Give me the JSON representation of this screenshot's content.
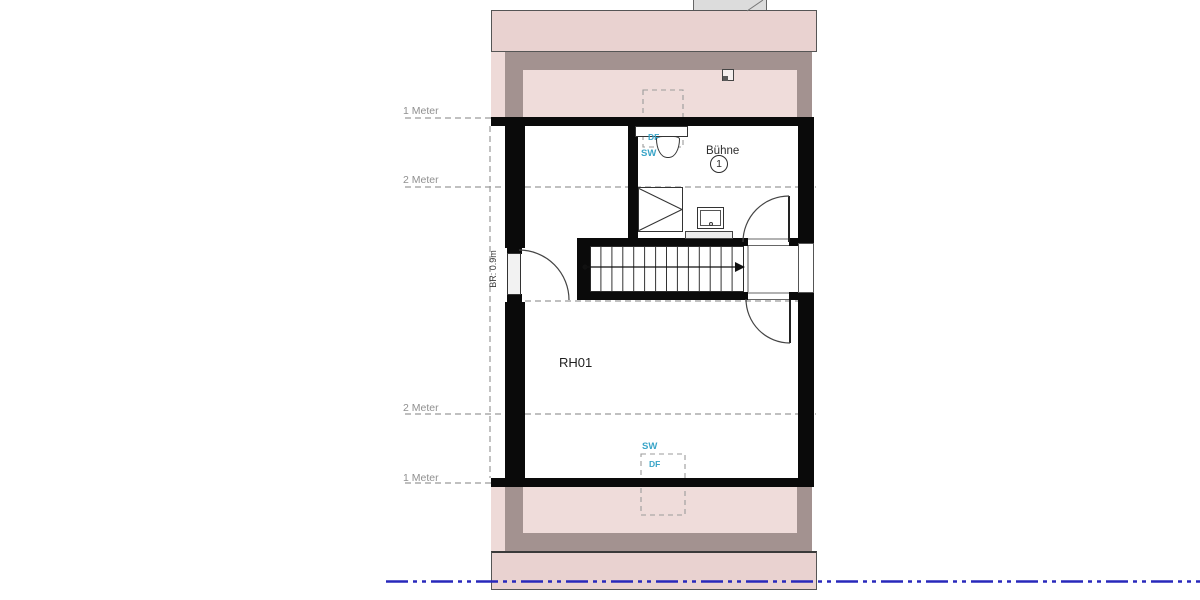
{
  "plan": {
    "room_main_label": "RH01",
    "room_upper_label": "Bühne",
    "room_upper_number": "1",
    "door_width_label": "BR: 0.9m",
    "height_lines": [
      {
        "label": "1 Meter"
      },
      {
        "label": "2 Meter"
      },
      {
        "label": "2 Meter"
      },
      {
        "label": "1 Meter"
      }
    ],
    "skylight_top": {
      "line1": "DF",
      "line2": "SW"
    },
    "skylight_bottom": {
      "line1": "SW",
      "line2": "DF"
    },
    "colors": {
      "roof_band": "#e9d2d0",
      "roof_strip_light": "#eedad8",
      "roof_inner": "#efdcda",
      "wall_plate_mauve": "#a39290",
      "wall_black": "#0a0a0a",
      "guide_dash_gray": "#9a9a9a",
      "section_line_blue": "#2828bb",
      "skylight_label_cyan": "#3aa5c8"
    }
  }
}
